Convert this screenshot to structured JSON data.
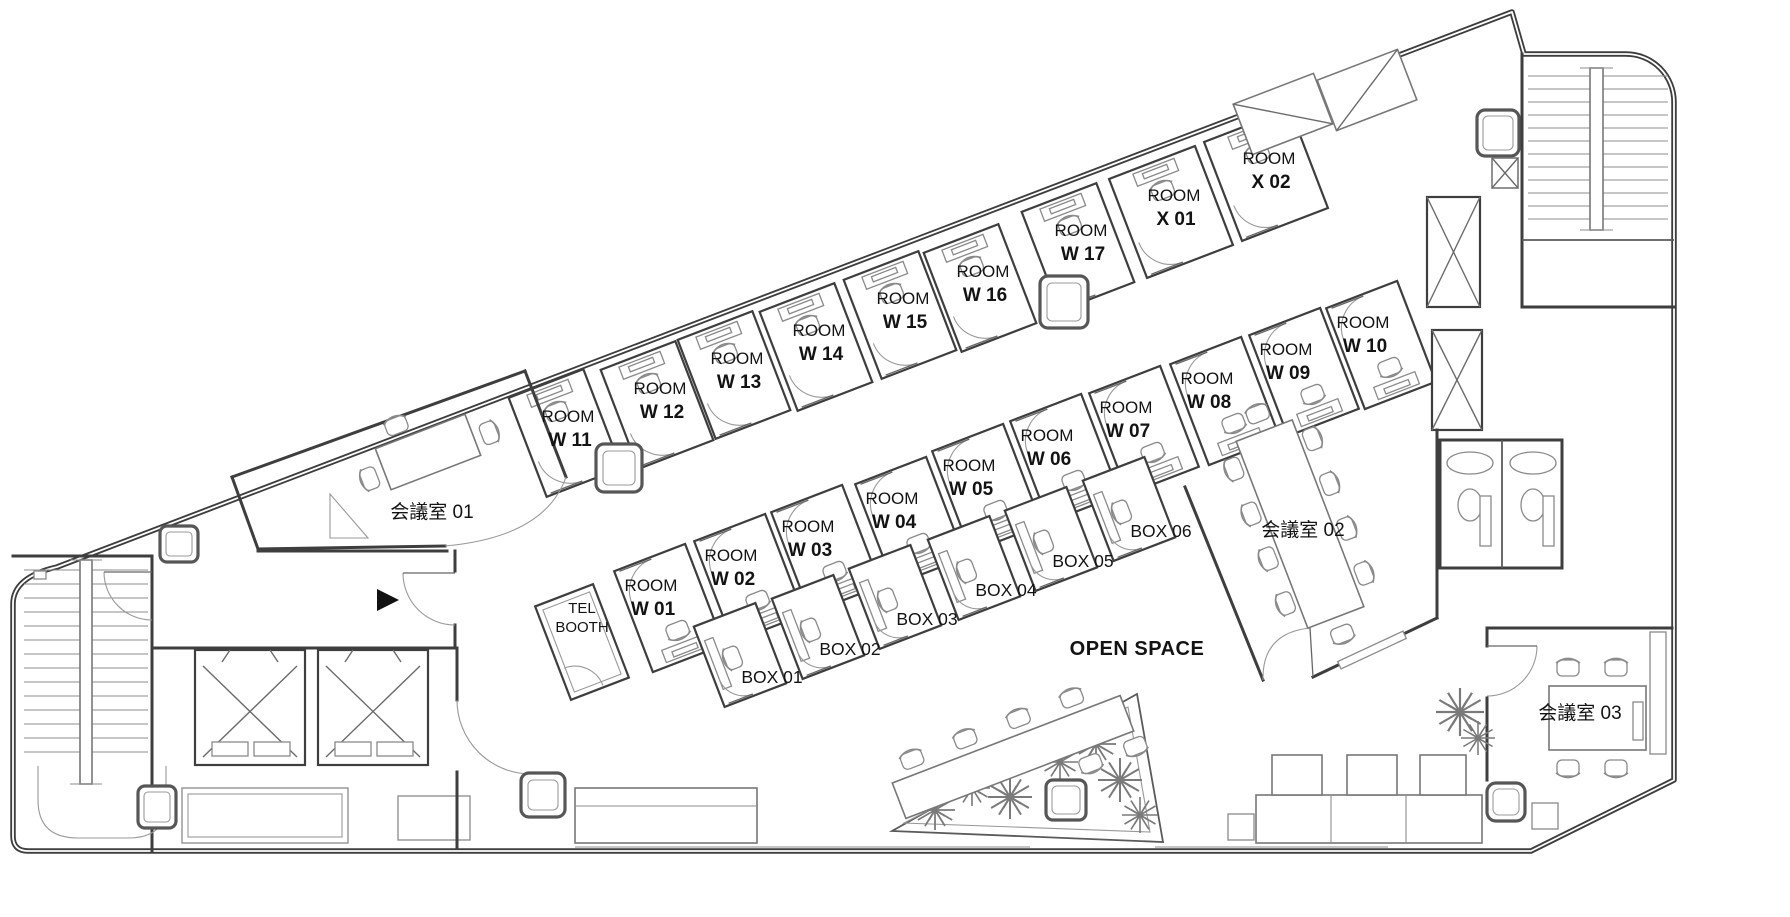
{
  "plan": {
    "colors": {
      "background": "#ffffff",
      "walls": "#3e3e3e",
      "furniture": "#8a8a8a",
      "text": "#131313"
    },
    "rooms": {
      "top_band": [
        {
          "id": "W11",
          "line1": "ROOM",
          "line2": "W 11",
          "x": 568,
          "y": 417
        },
        {
          "id": "W12",
          "line1": "ROOM",
          "line2": "W 12",
          "x": 660,
          "y": 389
        },
        {
          "id": "W13",
          "line1": "ROOM",
          "line2": "W 13",
          "x": 737,
          "y": 359
        },
        {
          "id": "W14",
          "line1": "ROOM",
          "line2": "W 14",
          "x": 819,
          "y": 331
        },
        {
          "id": "W15",
          "line1": "ROOM",
          "line2": "W 15",
          "x": 903,
          "y": 299
        },
        {
          "id": "W16",
          "line1": "ROOM",
          "line2": "W 16",
          "x": 983,
          "y": 272
        },
        {
          "id": "W17",
          "line1": "ROOM",
          "line2": "W 17",
          "x": 1081,
          "y": 231
        },
        {
          "id": "X01",
          "line1": "ROOM",
          "line2": "X 01",
          "x": 1174,
          "y": 196
        },
        {
          "id": "X02",
          "line1": "ROOM",
          "line2": "X 02",
          "x": 1269,
          "y": 159
        }
      ],
      "mid_band": [
        {
          "id": "W01",
          "line1": "ROOM",
          "line2": "W 01",
          "x": 651,
          "y": 586
        },
        {
          "id": "W02",
          "line1": "ROOM",
          "line2": "W 02",
          "x": 731,
          "y": 556
        },
        {
          "id": "W03",
          "line1": "ROOM",
          "line2": "W 03",
          "x": 808,
          "y": 527
        },
        {
          "id": "W04",
          "line1": "ROOM",
          "line2": "W 04",
          "x": 892,
          "y": 499
        },
        {
          "id": "W05",
          "line1": "ROOM",
          "line2": "W 05",
          "x": 969,
          "y": 466
        },
        {
          "id": "W06",
          "line1": "ROOM",
          "line2": "W 06",
          "x": 1047,
          "y": 436
        },
        {
          "id": "W07",
          "line1": "ROOM",
          "line2": "W 07",
          "x": 1126,
          "y": 408
        },
        {
          "id": "W08",
          "line1": "ROOM",
          "line2": "W 08",
          "x": 1207,
          "y": 379
        },
        {
          "id": "W09",
          "line1": "ROOM",
          "line2": "W 09",
          "x": 1286,
          "y": 350
        },
        {
          "id": "W10",
          "line1": "ROOM",
          "line2": "W 10",
          "x": 1363,
          "y": 323
        }
      ],
      "phone_boxes": [
        {
          "id": "BOX01",
          "label": "BOX 01",
          "x": 772,
          "y": 677
        },
        {
          "id": "BOX02",
          "label": "BOX 02",
          "x": 850,
          "y": 649
        },
        {
          "id": "BOX03",
          "label": "BOX 03",
          "x": 927,
          "y": 619
        },
        {
          "id": "BOX04",
          "label": "BOX 04",
          "x": 1006,
          "y": 590
        },
        {
          "id": "BOX05",
          "label": "BOX 05",
          "x": 1083,
          "y": 561
        },
        {
          "id": "BOX06",
          "label": "BOX 06",
          "x": 1161,
          "y": 531
        }
      ]
    },
    "meeting_rooms": [
      {
        "id": "kaigishitsu-01",
        "label": "会議室 01",
        "x": 432,
        "y": 512
      },
      {
        "id": "kaigishitsu-02",
        "label": "会議室 02",
        "x": 1303,
        "y": 530
      },
      {
        "id": "kaigishitsu-03",
        "label": "会議室 03",
        "x": 1580,
        "y": 713
      }
    ],
    "areas": [
      {
        "id": "open-space",
        "label": "OPEN SPACE",
        "x": 1137,
        "y": 648
      },
      {
        "id": "tel-booth",
        "line1": "TEL",
        "line2": "BOOTH",
        "x": 582,
        "y": 608
      }
    ],
    "markers": [
      {
        "id": "entrance-arrow",
        "shape": "triangle-right",
        "x": 388,
        "y": 600
      }
    ],
    "structures": [
      "staircase-left",
      "staircase-top-right",
      "elevator-1",
      "elevator-2",
      "restrooms",
      "service-shafts",
      "lockers",
      "ducts",
      "lounge-sofa",
      "kitchen-counter",
      "open-space-planter"
    ]
  }
}
